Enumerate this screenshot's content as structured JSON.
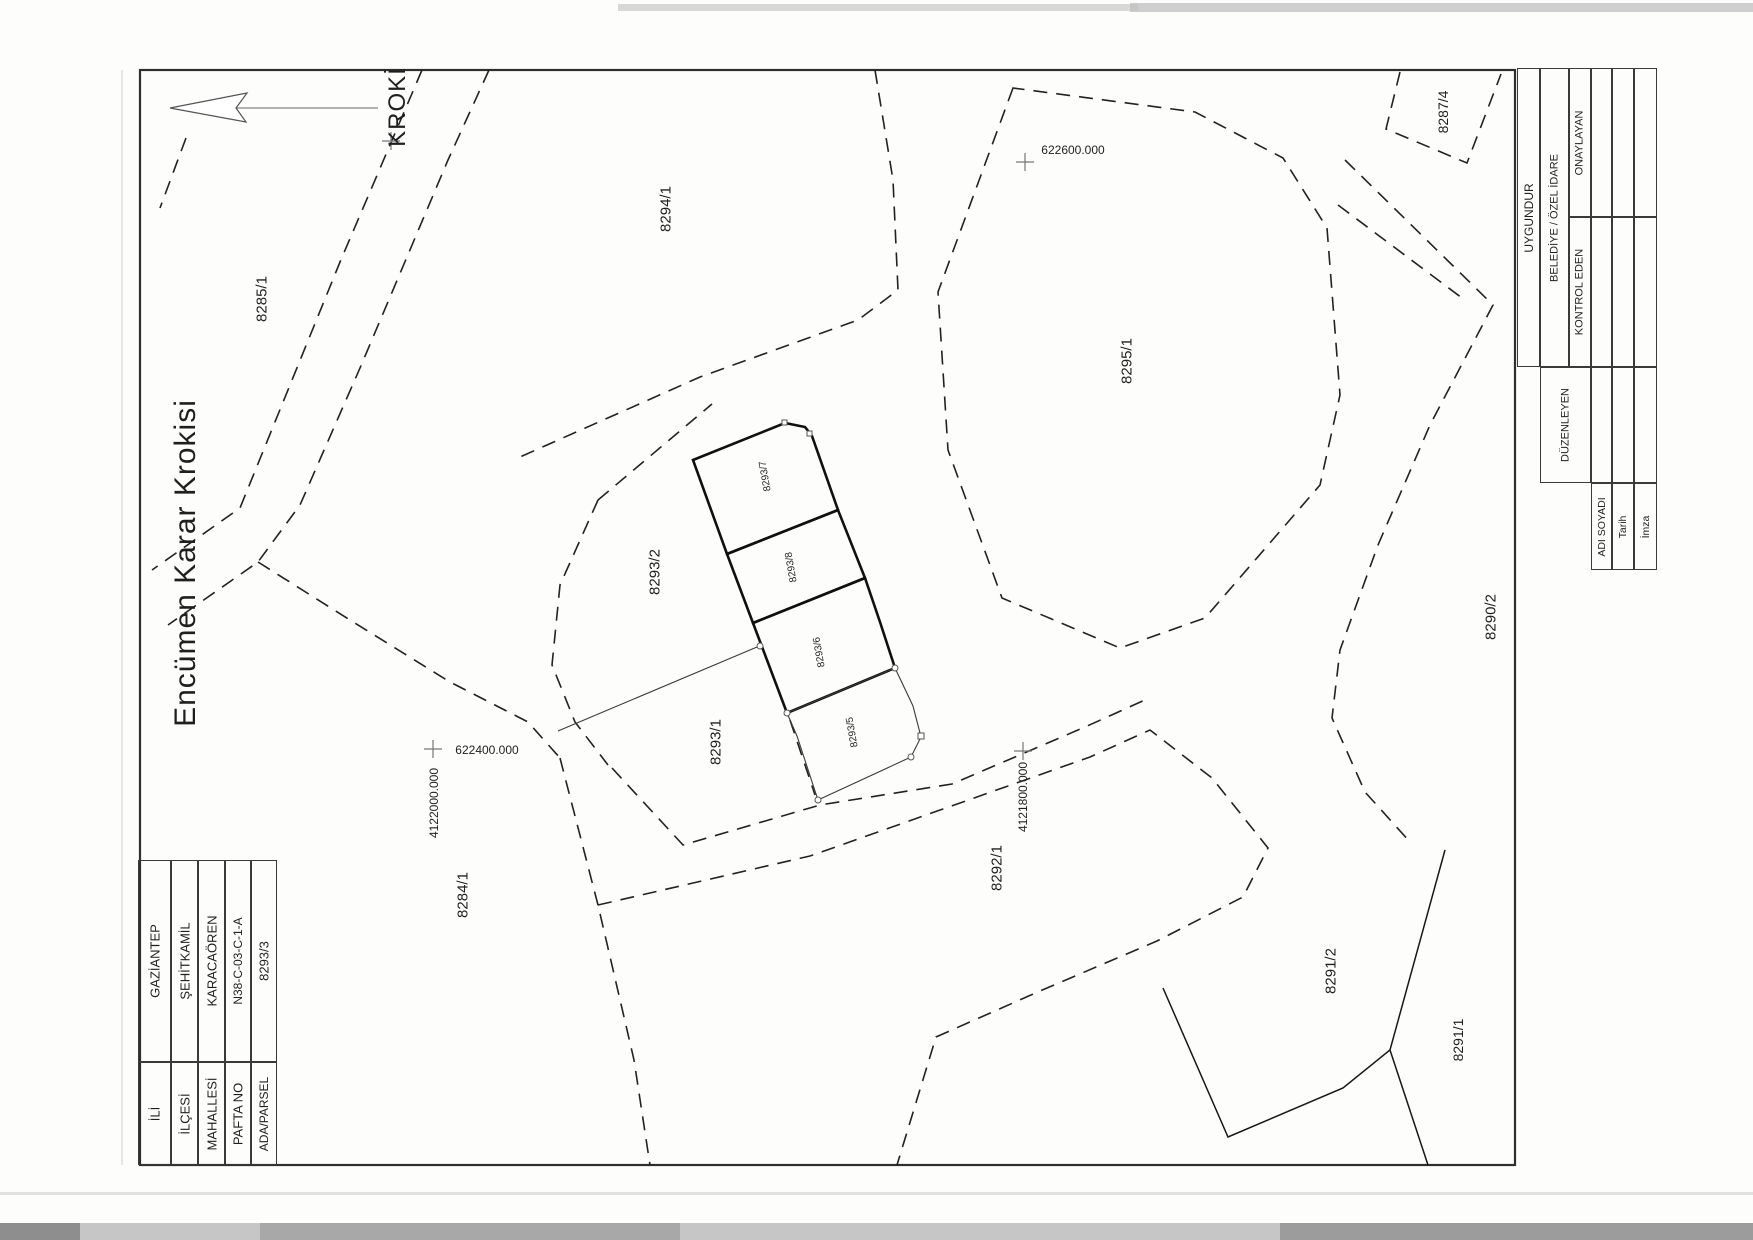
{
  "document": {
    "title": "Encümen Karar Krokisi",
    "map_heading": "KROKİ"
  },
  "info_table": {
    "rows": [
      {
        "label": "İLİ",
        "value": "GAZİANTEP"
      },
      {
        "label": "İLÇESİ",
        "value": "ŞEHİTKAMİL"
      },
      {
        "label": "MAHALLESİ",
        "value": "KARACAÖREN"
      },
      {
        "label": "PAFTA NO",
        "value": "N38-C-03-C-1-A"
      },
      {
        "label": "ADA/PARSEL",
        "value": "8293/3"
      }
    ]
  },
  "approval_table": {
    "header": "UYGUNDUR",
    "authority": "BELEDİYE / ÖZEL İDARE",
    "role_onaylayan": "ONAYLAYAN",
    "role_kontrol": "KONTROL EDEN",
    "role_duzenleyen": "DÜZENLEYEN",
    "row_adi": "ADI SOYADI",
    "row_tarih": "Tarih",
    "row_imza": "İmza"
  },
  "map": {
    "parcels": [
      "8285/1",
      "8294/1",
      "8295/1",
      "8287/4",
      "8290/2",
      "8284/1",
      "8292/1",
      "8291/2",
      "8291/1",
      "8293/2",
      "8293/1",
      "8293/7",
      "8293/8",
      "8293/6",
      "8293/5"
    ],
    "grid_labels": {
      "easting_600": "622600.000",
      "easting_400": "622400.000",
      "northing_2000": "4122000.000",
      "northing_1800": "4121800.000"
    }
  }
}
